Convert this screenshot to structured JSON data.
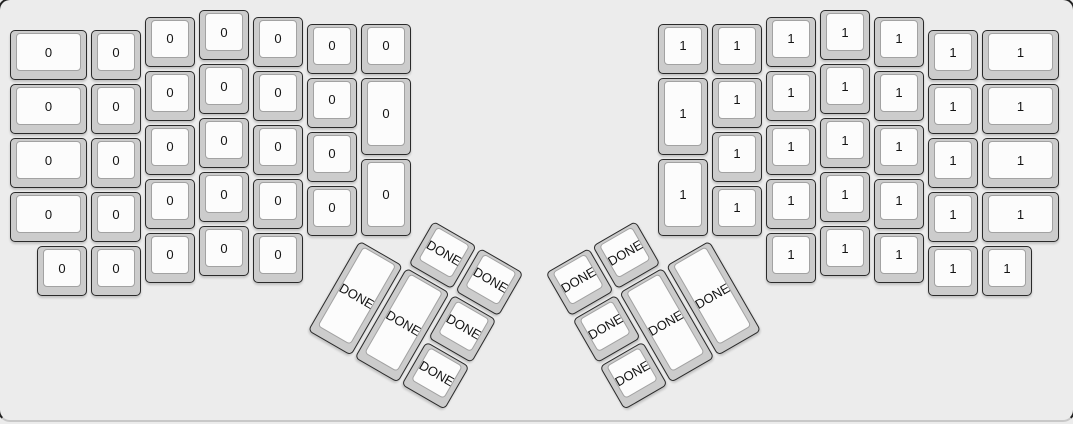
{
  "app": {
    "name": "keyboard-layout-editor-canvas"
  },
  "canvas": {
    "width_px": 1073,
    "height_px": 424,
    "unit_px": 54,
    "origin_px": {
      "x": 8,
      "y": 8
    },
    "background": "#ececec"
  },
  "colors": {
    "keycap_base": "#cccccc",
    "keycap_top_surface": "#fcfcfc",
    "keycap_border": "#2a2a2a",
    "keycap_top_border": "#a2a2a2",
    "label_color": "#141414",
    "case_border": "#222222",
    "case_bottom_edge": "#c8c8c8"
  },
  "keyboard": {
    "groups": [
      {
        "id": "left-main-keys",
        "label": "0",
        "rotation_deg": 0,
        "keys": [
          [
            0,
            0.375,
            1.5,
            1
          ],
          [
            0,
            1.375,
            1.5,
            1
          ],
          [
            0,
            2.375,
            1.5,
            1
          ],
          [
            0,
            3.375,
            1.5,
            1
          ],
          [
            0.5,
            4.375,
            1,
            1
          ],
          [
            1.5,
            0.375,
            1,
            1
          ],
          [
            1.5,
            1.375,
            1,
            1
          ],
          [
            1.5,
            2.375,
            1,
            1
          ],
          [
            1.5,
            3.375,
            1,
            1
          ],
          [
            1.5,
            4.375,
            1,
            1
          ],
          [
            2.5,
            0.125,
            1,
            1
          ],
          [
            2.5,
            1.125,
            1,
            1
          ],
          [
            2.5,
            2.125,
            1,
            1
          ],
          [
            2.5,
            3.125,
            1,
            1
          ],
          [
            2.5,
            4.125,
            1,
            1
          ],
          [
            3.5,
            0,
            1,
            1
          ],
          [
            3.5,
            1,
            1,
            1
          ],
          [
            3.5,
            2,
            1,
            1
          ],
          [
            3.5,
            3,
            1,
            1
          ],
          [
            3.5,
            4,
            1,
            1
          ],
          [
            4.5,
            0.125,
            1,
            1
          ],
          [
            4.5,
            1.125,
            1,
            1
          ],
          [
            4.5,
            2.125,
            1,
            1
          ],
          [
            4.5,
            3.125,
            1,
            1
          ],
          [
            4.5,
            4.125,
            1,
            1
          ],
          [
            5.5,
            0.25,
            1,
            1
          ],
          [
            5.5,
            1.25,
            1,
            1
          ],
          [
            5.5,
            2.25,
            1,
            1
          ],
          [
            5.5,
            3.25,
            1,
            1
          ],
          [
            6.5,
            0.25,
            1,
            1
          ],
          [
            6.5,
            1.25,
            1,
            1.5
          ],
          [
            6.5,
            2.75,
            1,
            1.5
          ]
        ]
      },
      {
        "id": "right-main-keys",
        "label": "1",
        "rotation_deg": 0,
        "keys": [
          [
            12,
            0.25,
            1,
            1
          ],
          [
            12,
            1.25,
            1,
            1.5
          ],
          [
            12,
            2.75,
            1,
            1.5
          ],
          [
            13,
            0.25,
            1,
            1
          ],
          [
            13,
            1.25,
            1,
            1
          ],
          [
            13,
            2.25,
            1,
            1
          ],
          [
            13,
            3.25,
            1,
            1
          ],
          [
            14,
            0.125,
            1,
            1
          ],
          [
            14,
            1.125,
            1,
            1
          ],
          [
            14,
            2.125,
            1,
            1
          ],
          [
            14,
            3.125,
            1,
            1
          ],
          [
            14,
            4.125,
            1,
            1
          ],
          [
            15,
            0,
            1,
            1
          ],
          [
            15,
            1,
            1,
            1
          ],
          [
            15,
            2,
            1,
            1
          ],
          [
            15,
            3,
            1,
            1
          ],
          [
            15,
            4,
            1,
            1
          ],
          [
            16,
            0.125,
            1,
            1
          ],
          [
            16,
            1.125,
            1,
            1
          ],
          [
            16,
            2.125,
            1,
            1
          ],
          [
            16,
            3.125,
            1,
            1
          ],
          [
            16,
            4.125,
            1,
            1
          ],
          [
            17,
            0.375,
            1,
            1
          ],
          [
            17,
            1.375,
            1,
            1
          ],
          [
            17,
            2.375,
            1,
            1
          ],
          [
            17,
            3.375,
            1,
            1
          ],
          [
            17,
            4.375,
            1,
            1
          ],
          [
            18,
            0.375,
            1.5,
            1
          ],
          [
            18,
            1.375,
            1.5,
            1
          ],
          [
            18,
            2.375,
            1.5,
            1
          ],
          [
            18,
            3.375,
            1.5,
            1
          ],
          [
            18,
            4.375,
            1,
            1
          ]
        ]
      },
      {
        "id": "left-thumb-cluster",
        "label": "DONE",
        "rotation_deg": 30,
        "pivot_u": {
          "x": 6.5,
          "y": 4.25
        },
        "keys": [
          [
            1,
            -1,
            1,
            1
          ],
          [
            2,
            -1,
            1,
            1
          ],
          [
            0,
            0,
            1,
            2
          ],
          [
            1,
            0,
            1,
            2
          ],
          [
            2,
            0,
            1,
            1
          ],
          [
            2,
            1,
            1,
            1
          ]
        ]
      },
      {
        "id": "right-thumb-cluster",
        "label": "DONE",
        "rotation_deg": -30,
        "pivot_u": {
          "x": 13,
          "y": 4.25
        },
        "keys": [
          [
            -3,
            -1,
            1,
            1
          ],
          [
            -2,
            -1,
            1,
            1
          ],
          [
            -3,
            0,
            1,
            1
          ],
          [
            -2,
            0,
            1,
            2
          ],
          [
            -1,
            0,
            1,
            2
          ],
          [
            -3,
            1,
            1,
            1
          ]
        ]
      }
    ]
  }
}
